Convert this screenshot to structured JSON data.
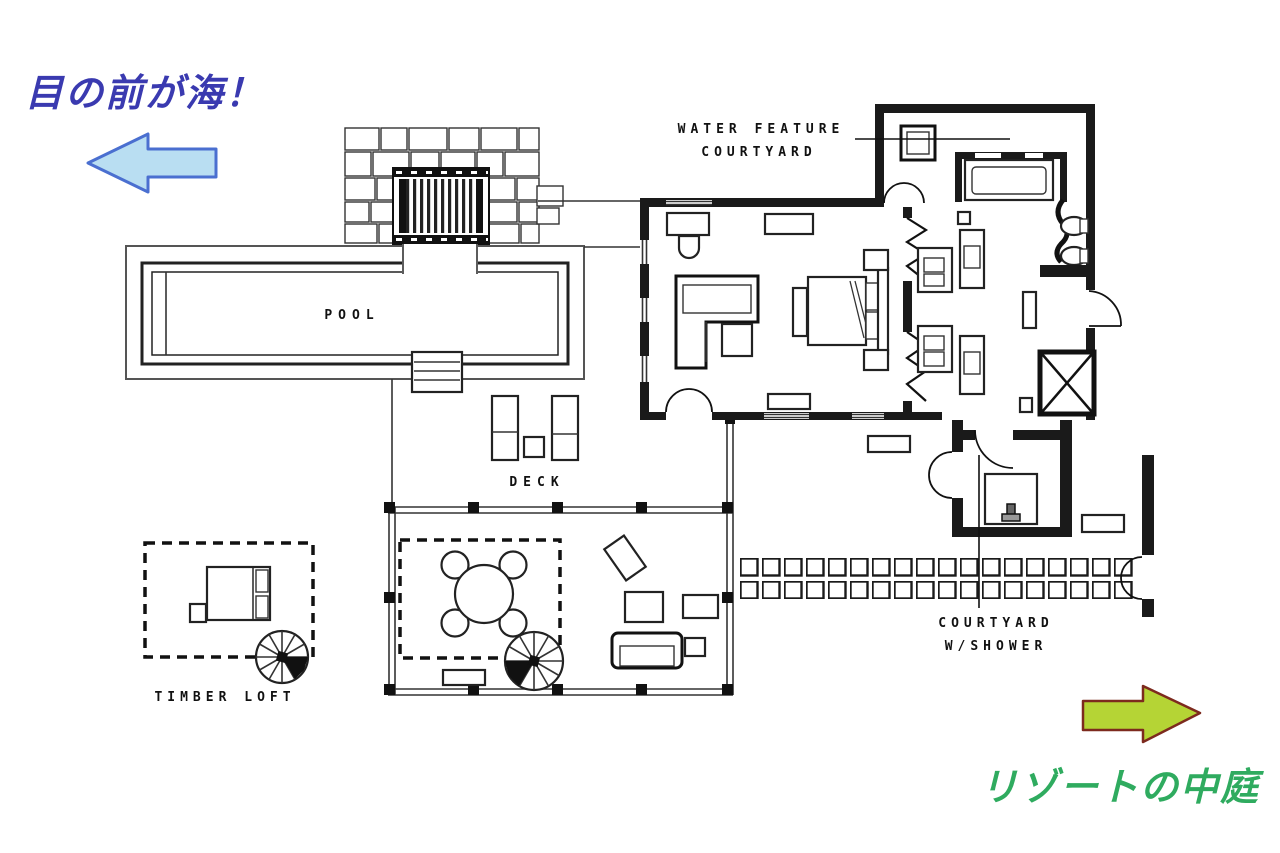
{
  "annotations": {
    "sea_note": "目の前が海！",
    "resort_note": "リゾートの中庭"
  },
  "plan_labels": {
    "water_feature_line1": "WATER FEATURE",
    "water_feature_line2": "COURTYARD",
    "pool": "POOL",
    "deck": "DECK",
    "timber_loft": "TIMBER LOFT",
    "courtyard_line1": "COURTYARD",
    "courtyard_line2": "W/SHOWER"
  },
  "colors": {
    "sea_note_text": "#3a3ab0",
    "sea_arrow_fill": "#b9def2",
    "sea_arrow_stroke": "#4a6fd0",
    "resort_note_text": "#2fab5f",
    "resort_arrow_fill": "#b5d435",
    "resort_arrow_stroke": "#7d2a1e",
    "plan_ink": "#1a1a1a"
  }
}
